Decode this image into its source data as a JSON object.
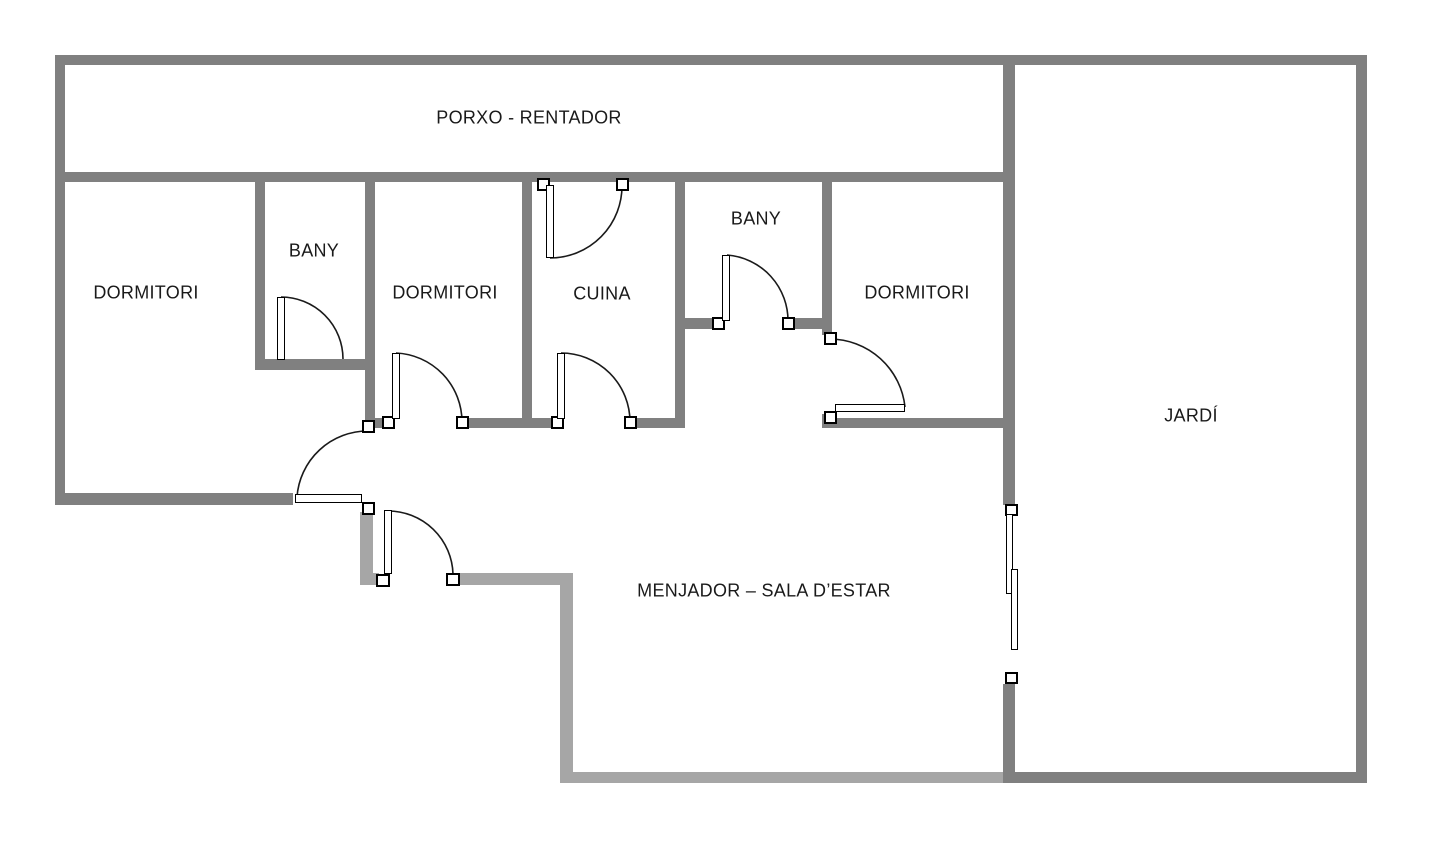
{
  "colors": {
    "wall_dark": "#808080",
    "wall_light": "#a6a6a6",
    "door_line": "#1a1a1a",
    "text": "#1a1a1a",
    "background": "#ffffff"
  },
  "rooms": [
    {
      "id": "porxo",
      "label": "PORXO - RENTADOR",
      "cx": 529,
      "cy": 118
    },
    {
      "id": "dormitori-esquerra",
      "label": "DORMITORI",
      "cx": 146,
      "cy": 293
    },
    {
      "id": "bany-1",
      "label": "BANY",
      "cx": 314,
      "cy": 251
    },
    {
      "id": "dormitori-centre",
      "label": "DORMITORI",
      "cx": 445,
      "cy": 293
    },
    {
      "id": "cuina",
      "label": "CUINA",
      "cx": 602,
      "cy": 294
    },
    {
      "id": "bany-2",
      "label": "BANY",
      "cx": 756,
      "cy": 219
    },
    {
      "id": "dormitori-dreta",
      "label": "DORMITORI",
      "cx": 917,
      "cy": 293
    },
    {
      "id": "jardi",
      "label": "JARDÍ",
      "cx": 1191,
      "cy": 416
    },
    {
      "id": "menjador",
      "label": "MENJADOR – SALA D’ESTAR",
      "cx": 764,
      "cy": 591
    }
  ],
  "floorplan": {
    "walls": [
      {
        "name": "outer-top-wall",
        "x": 55,
        "y": 55,
        "w": 1312,
        "h": 10,
        "tone": "dark"
      },
      {
        "name": "outer-left-wall",
        "x": 55,
        "y": 55,
        "w": 10,
        "h": 450,
        "tone": "dark"
      },
      {
        "name": "porxo-divider-wall",
        "x": 55,
        "y": 172,
        "w": 948,
        "h": 10,
        "tone": "dark"
      },
      {
        "name": "right-wall-upper",
        "x": 1003,
        "y": 55,
        "w": 12,
        "h": 450,
        "tone": "dark"
      },
      {
        "name": "right-wall-lower",
        "x": 1003,
        "y": 684,
        "w": 12,
        "h": 99,
        "tone": "dark"
      },
      {
        "name": "jardi-right-wall",
        "x": 1356,
        "y": 55,
        "w": 11,
        "h": 728,
        "tone": "dark"
      },
      {
        "name": "jardi-bottom-wall",
        "x": 1003,
        "y": 772,
        "w": 364,
        "h": 11,
        "tone": "dark"
      },
      {
        "name": "bany1-left-wall",
        "x": 255,
        "y": 182,
        "w": 10,
        "h": 188,
        "tone": "dark"
      },
      {
        "name": "bany1-bottom-wall",
        "x": 255,
        "y": 359,
        "w": 120,
        "h": 11,
        "tone": "dark"
      },
      {
        "name": "bany1-right-wall",
        "x": 365,
        "y": 182,
        "w": 10,
        "h": 244,
        "tone": "dark"
      },
      {
        "name": "cuina-left-wall",
        "x": 522,
        "y": 182,
        "w": 10,
        "h": 246,
        "tone": "dark"
      },
      {
        "name": "cuina-right-wall",
        "x": 675,
        "y": 182,
        "w": 10,
        "h": 246,
        "tone": "dark"
      },
      {
        "name": "bany2-bottom-wall-left",
        "x": 685,
        "y": 318,
        "w": 30,
        "h": 11,
        "tone": "dark"
      },
      {
        "name": "bany2-bottom-wall-right",
        "x": 791,
        "y": 318,
        "w": 36,
        "h": 11,
        "tone": "dark"
      },
      {
        "name": "bany2-right-wall",
        "x": 822,
        "y": 182,
        "w": 10,
        "h": 153,
        "tone": "dark"
      },
      {
        "name": "dorm3-left-wall-stub",
        "x": 822,
        "y": 414,
        "w": 10,
        "h": 14,
        "tone": "dark"
      },
      {
        "name": "hall-bottom-wall-a",
        "x": 365,
        "y": 418,
        "w": 22,
        "h": 10,
        "tone": "dark"
      },
      {
        "name": "hall-bottom-wall-b",
        "x": 464,
        "y": 418,
        "w": 89,
        "h": 10,
        "tone": "dark"
      },
      {
        "name": "hall-bottom-wall-c",
        "x": 633,
        "y": 418,
        "w": 52,
        "h": 10,
        "tone": "dark"
      },
      {
        "name": "dorm3-bottom-wall",
        "x": 822,
        "y": 418,
        "w": 181,
        "h": 10,
        "tone": "dark"
      },
      {
        "name": "dorm1-bottom-wall",
        "x": 55,
        "y": 493,
        "w": 238,
        "h": 12,
        "tone": "dark"
      },
      {
        "name": "menjador-left-wall-upper",
        "x": 360,
        "y": 512,
        "w": 13,
        "h": 73,
        "tone": "light"
      },
      {
        "name": "menjador-top-wall-a",
        "x": 360,
        "y": 573,
        "w": 19,
        "h": 12,
        "tone": "light"
      },
      {
        "name": "menjador-top-wall-b",
        "x": 456,
        "y": 573,
        "w": 117,
        "h": 12,
        "tone": "light"
      },
      {
        "name": "menjador-left-wall-lower",
        "x": 560,
        "y": 573,
        "w": 13,
        "h": 210,
        "tone": "light"
      },
      {
        "name": "menjador-bottom-wall",
        "x": 560,
        "y": 772,
        "w": 443,
        "h": 11,
        "tone": "light"
      }
    ],
    "jambs": [
      {
        "name": "cuina-top-door-hinge-jamb",
        "x": 537,
        "y": 178,
        "w": 13,
        "h": 13
      },
      {
        "name": "cuina-top-door-latch-jamb",
        "x": 616,
        "y": 178,
        "w": 13,
        "h": 13
      },
      {
        "name": "dorm2-door-hinge-jamb",
        "x": 382,
        "y": 416,
        "w": 13,
        "h": 13
      },
      {
        "name": "dorm2-door-latch-jamb",
        "x": 456,
        "y": 416,
        "w": 13,
        "h": 13
      },
      {
        "name": "cuina-bottom-door-hinge-jamb",
        "x": 551,
        "y": 416,
        "w": 13,
        "h": 13
      },
      {
        "name": "cuina-bottom-door-latch-jamb",
        "x": 624,
        "y": 416,
        "w": 13,
        "h": 13
      },
      {
        "name": "bany2-door-hinge-jamb",
        "x": 712,
        "y": 317,
        "w": 13,
        "h": 13
      },
      {
        "name": "bany2-door-latch-jamb",
        "x": 782,
        "y": 317,
        "w": 13,
        "h": 13
      },
      {
        "name": "dorm3-door-latch-jamb",
        "x": 824,
        "y": 332,
        "w": 13,
        "h": 13
      },
      {
        "name": "dorm3-door-hinge-jamb",
        "x": 824,
        "y": 411,
        "w": 13,
        "h": 13
      },
      {
        "name": "dorm1-door-latch-jamb",
        "x": 362,
        "y": 420,
        "w": 13,
        "h": 13
      },
      {
        "name": "dorm1-door-hinge-jamb",
        "x": 362,
        "y": 502,
        "w": 13,
        "h": 13
      },
      {
        "name": "menjador-door-hinge-jamb",
        "x": 376,
        "y": 574,
        "w": 14,
        "h": 13
      },
      {
        "name": "menjador-door-latch-jamb",
        "x": 446,
        "y": 573,
        "w": 14,
        "h": 13
      },
      {
        "name": "slider-top-jamb",
        "x": 1005,
        "y": 504,
        "w": 13,
        "h": 12
      },
      {
        "name": "slider-bottom-jamb",
        "x": 1005,
        "y": 672,
        "w": 13,
        "h": 12
      }
    ],
    "leaves": [
      {
        "name": "bany1-door-leaf",
        "x": 277,
        "y": 297,
        "w": 8,
        "h": 63
      },
      {
        "name": "cuina-top-door-leaf",
        "x": 546,
        "y": 185,
        "w": 8,
        "h": 73
      },
      {
        "name": "dorm2-door-leaf",
        "x": 392,
        "y": 353,
        "w": 8,
        "h": 66
      },
      {
        "name": "cuina-bottom-door-leaf",
        "x": 557,
        "y": 353,
        "w": 8,
        "h": 66
      },
      {
        "name": "bany2-door-leaf",
        "x": 722,
        "y": 255,
        "w": 8,
        "h": 66
      },
      {
        "name": "dorm3-door-leaf",
        "x": 835,
        "y": 404,
        "w": 70,
        "h": 8
      },
      {
        "name": "dorm1-door-leaf",
        "x": 295,
        "y": 494,
        "w": 67,
        "h": 9
      },
      {
        "name": "menjador-door-leaf",
        "x": 384,
        "y": 510,
        "w": 8,
        "h": 64
      }
    ],
    "slider_panels": [
      {
        "name": "sliding-door-panel-outer",
        "x": 1006,
        "y": 514,
        "w": 7,
        "h": 80
      },
      {
        "name": "sliding-door-panel-inner",
        "x": 1011,
        "y": 569,
        "w": 7,
        "h": 81
      }
    ],
    "arcs": [
      {
        "name": "bany1-door-arc",
        "d": "M 281 297 A 62 62 0 0 1 343 359"
      },
      {
        "name": "cuina-top-door-arc",
        "d": "M 550 258 A 72 72 0 0 0 622 185"
      },
      {
        "name": "dorm2-door-arc",
        "d": "M 396 353 A 69 69 0 0 1 462 422"
      },
      {
        "name": "cuina-bottom-door-arc",
        "d": "M 561 353 A 69 69 0 0 1 630 422"
      },
      {
        "name": "bany2-door-arc",
        "d": "M 727 255 A 66 66 0 0 1 788 322"
      },
      {
        "name": "dorm3-door-arc",
        "d": "M 830 339 A 76 76 0 0 1 905 407"
      },
      {
        "name": "dorm1-door-arc",
        "d": "M 368 431 A 71 71 0 0 0 297 497"
      },
      {
        "name": "menjador-door-arc",
        "d": "M 388 511 A 65 65 0 0 1 453 574"
      }
    ]
  }
}
